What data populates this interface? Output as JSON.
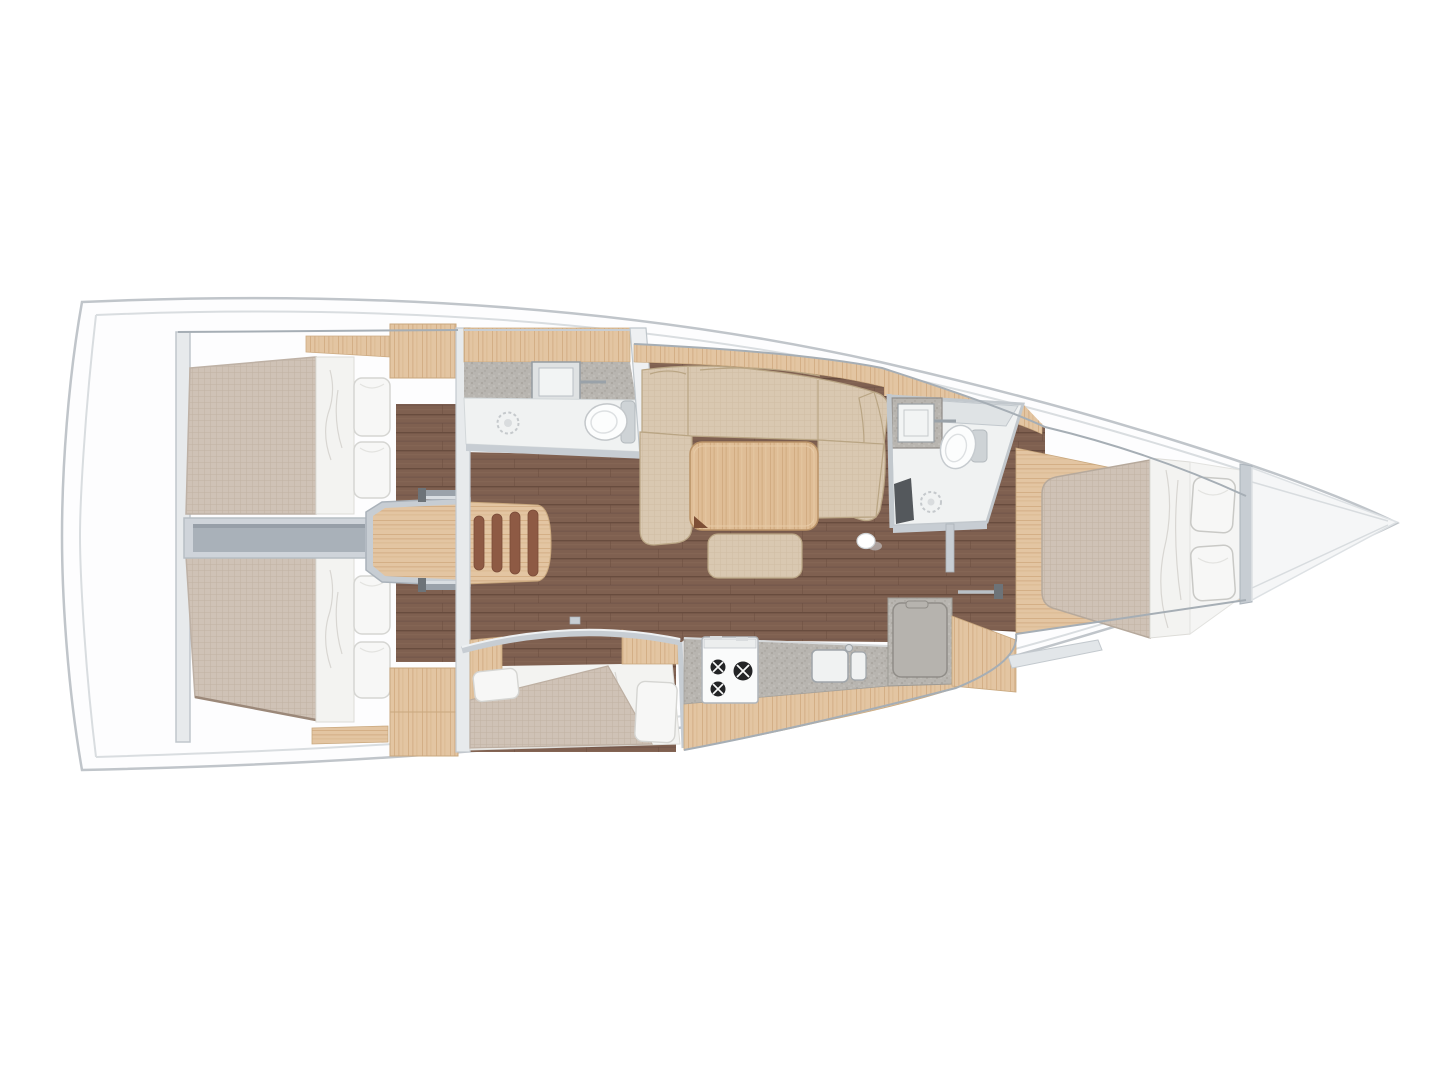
{
  "image": {
    "type": "sailboat-interior-floor-plan",
    "view": "top-down",
    "orientation": "bow-right",
    "background": "#ffffff"
  },
  "palette": {
    "hull_outline": "#c0c5ca",
    "hull_inner_line": "#d9dde0",
    "deck_white": "#fdfdfe",
    "trim_silver": "#c7cdd3",
    "trim_silver_dark": "#9aa2aa",
    "trim_silver_light": "#e9ecee",
    "bulkhead_fill": "#e7eaec",
    "floor_brown": "#7f6050",
    "floor_plank_line": "#684c3e",
    "wood_light": "#e3c5a2",
    "wood_grain": "#cfa87e",
    "wood_table": "#dfbd96",
    "stair_tread": "#8e5a44",
    "corridor_gray": "#a9b1b9",
    "corridor_frame": "#cfd4da",
    "mattress_beige": "#cfc2b6",
    "mattress_grid": "#c2b4a6",
    "sofa_beige": "#d9c8b1",
    "sofa_seam": "#b9a584",
    "bedding_white": "#f3f3f1",
    "pillow_white": "#f7f7f6",
    "pillow_stroke": "#d5d5d2",
    "counter_gray": "#b8b5b0",
    "counter_speckle": "#a49f99",
    "appliance_white": "#fafbfb",
    "burner_black": "#232426",
    "bath_floor": "#f0f2f2",
    "fixture_white": "#fcfdfd",
    "shower_seat_dark": "#54585c",
    "bow_wedge": "#f5f6f7"
  },
  "rooms": {
    "aft_cabin_port": {
      "label": "Aft cabin port with double berth",
      "pillow_count": 2
    },
    "aft_cabin_starboard": {
      "label": "Aft cabin starboard with double berth",
      "pillow_count": 2
    },
    "engine_corridor": {
      "label": "Engine compartment corridor between aft cabins"
    },
    "companionway": {
      "label": "Companionway entry steps",
      "step_count": 4
    },
    "aft_head": {
      "label": "Aft head with sink, toilet and shower drain"
    },
    "salon": {
      "label": "Salon with U-shaped settee, dining table and ottoman"
    },
    "mid_cabin": {
      "label": "Mid cabin berth with blanket",
      "pillow_count": 2
    },
    "galley": {
      "label": "Galley with stove, double sink and top-loading fridge",
      "burner_count": 3
    },
    "forward_head": {
      "label": "Forward head with sink, toilet, shower drain and seat"
    },
    "forward_cabin": {
      "label": "Forward owner cabin with island berth",
      "pillow_count": 2
    },
    "bow": {
      "label": "Bow anchor locker"
    }
  }
}
